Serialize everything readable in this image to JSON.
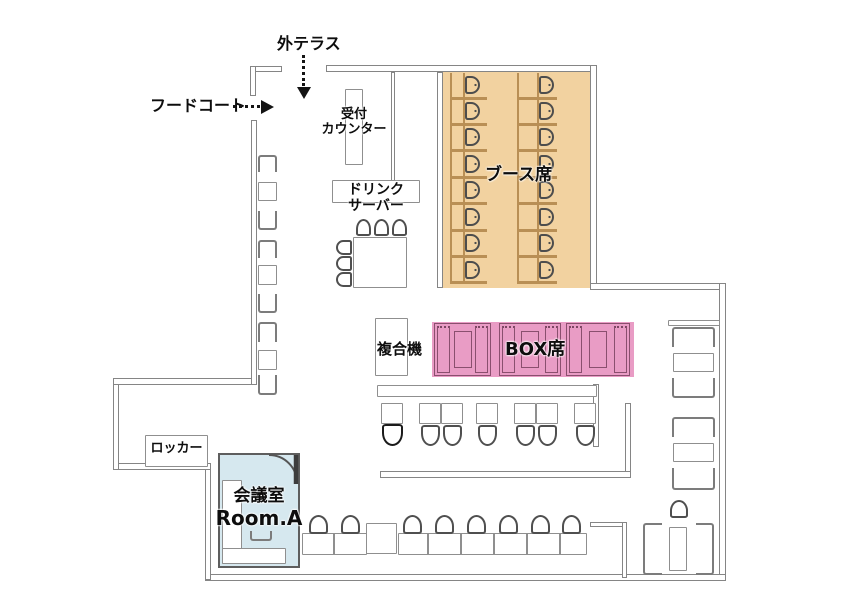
{
  "labels": {
    "outdoor_terrace": "外テラス",
    "food_court": "フードコート",
    "reception_line1": "受付",
    "reception_line2": "カウンター",
    "drink_line1": "ドリンク",
    "drink_line2": "サーバー",
    "booth_seats": "ブース席",
    "box_seats": "BOX席",
    "copier": "複合機",
    "locker": "ロッカー",
    "meeting_room_line1": "会議室",
    "meeting_room_line2": "Room.A"
  },
  "colors": {
    "booth_fill": "#f2d2a0",
    "box_fill": "#e99cc5",
    "meeting_room_fill": "#d6e8ef",
    "wall": "#858585",
    "text": "#0d0d0d"
  },
  "depicted_counts": {
    "booth_chairs": 16,
    "box_units": 3,
    "middle_row_tables": 7,
    "bottom_counter_chairs": 8,
    "left_wall_table_sets": 3,
    "right_wall_table_sets": 3,
    "drink_table_chairs": 6,
    "meeting_rooms": 1
  }
}
